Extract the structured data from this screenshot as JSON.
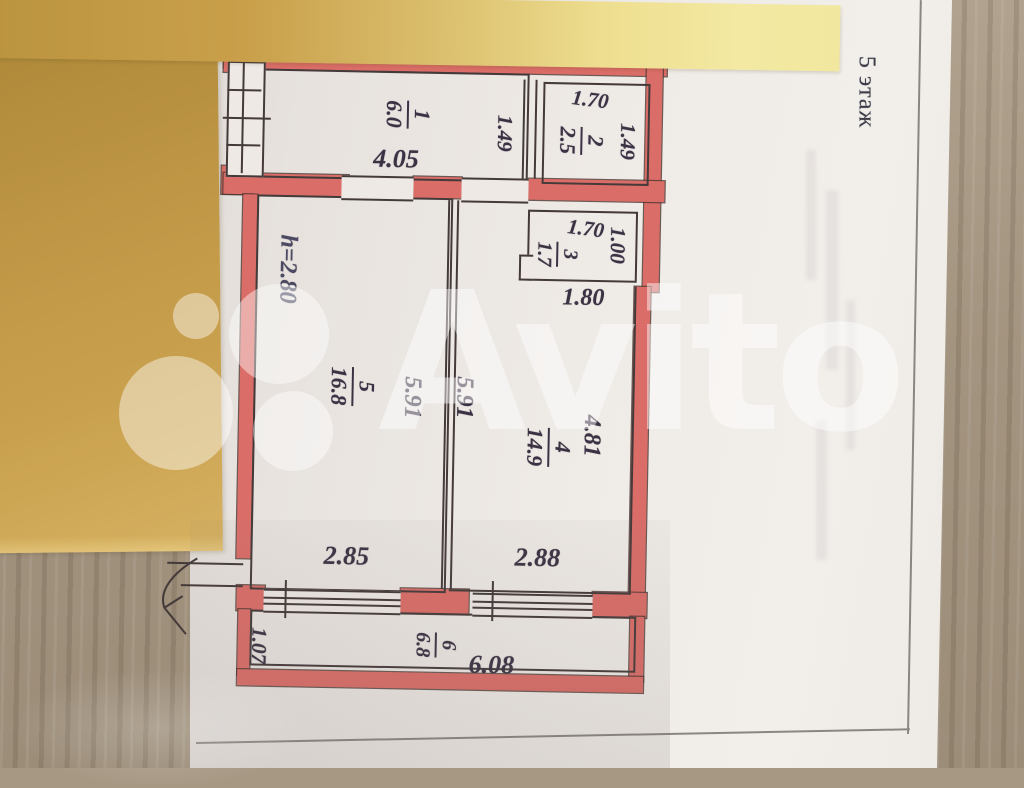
{
  "photo": {
    "floor_label": "5 этаж",
    "watermark": "Avito"
  },
  "colors": {
    "wall_red": "#db6d68",
    "sticky_note_mustard": "#c49c4a",
    "sticky_note_light_yellow": "#f1e79e",
    "paper": "#e9e5e1",
    "ink": "#3b3244"
  },
  "plan": {
    "ceiling_height": "h=2.80",
    "rooms": [
      {
        "number": "1",
        "area": "6.0"
      },
      {
        "number": "2",
        "area": "2.5"
      },
      {
        "number": "3",
        "area": "1.7"
      },
      {
        "number": "4",
        "area": "14.9"
      },
      {
        "number": "5",
        "area": "16.8"
      },
      {
        "number": "6",
        "area": "6.8"
      }
    ],
    "dims": {
      "room1_width": "4.05",
      "room1_depth": "1.49",
      "room2_width": "1.70",
      "room2_depth": "1.49",
      "room3_width": "1.70",
      "room3_depth": "1.00",
      "room3_outer": "1.80",
      "room5_length": "5.91",
      "room4_length": "5.91",
      "room4_depth": "4.81",
      "room5_width": "2.85",
      "room4_width": "2.88",
      "balcony_width": "6.08",
      "balcony_depth": "1.07"
    }
  }
}
